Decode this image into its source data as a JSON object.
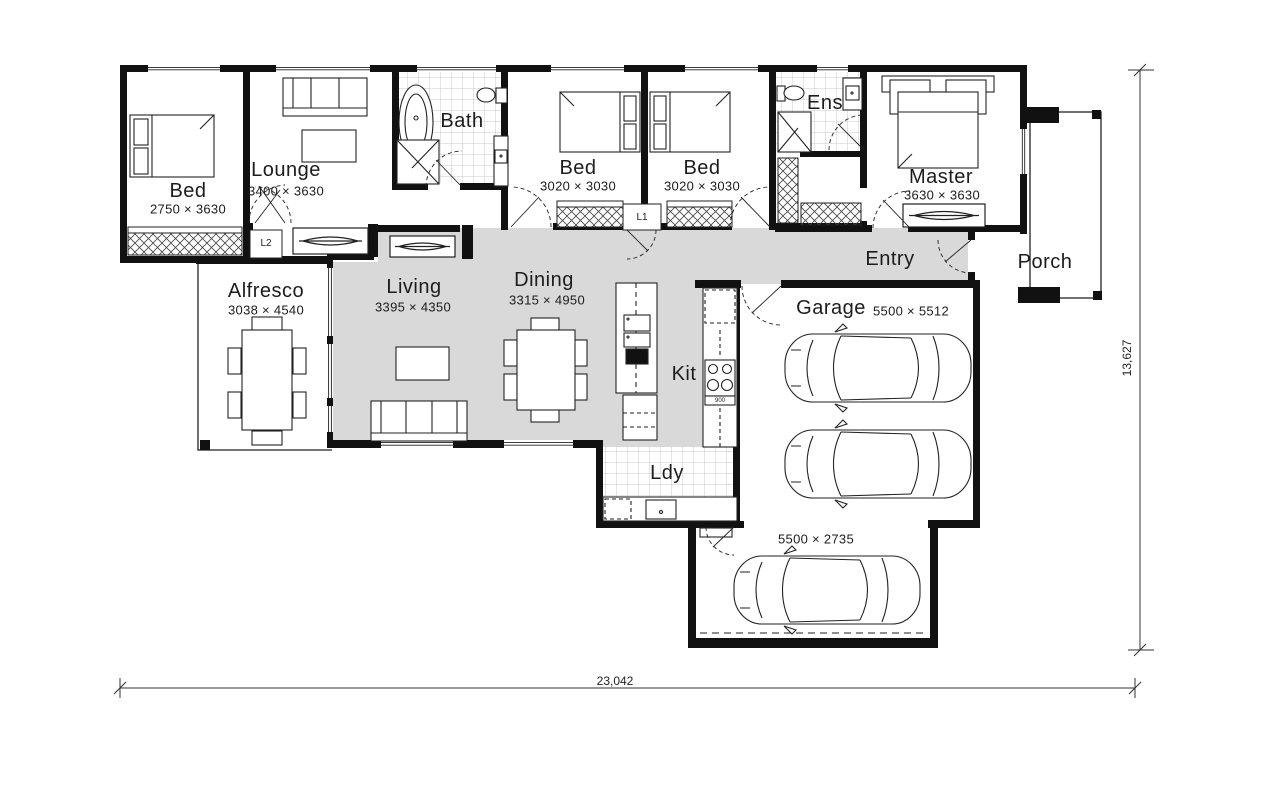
{
  "plan": {
    "rooms": {
      "bed1": {
        "name": "Bed",
        "dims": "2750 × 3630"
      },
      "lounge": {
        "name": "Lounge",
        "dims": "3400 × 3630"
      },
      "bath": {
        "name": "Bath"
      },
      "bed2": {
        "name": "Bed",
        "dims": "3020 × 3030"
      },
      "bed3": {
        "name": "Bed",
        "dims": "3020 × 3030"
      },
      "ens": {
        "name": "Ens"
      },
      "master": {
        "name": "Master",
        "dims": "3630 × 3630"
      },
      "entry": {
        "name": "Entry"
      },
      "porch": {
        "name": "Porch"
      },
      "alfresco": {
        "name": "Alfresco",
        "dims": "3038 × 4540"
      },
      "living": {
        "name": "Living",
        "dims": "3395 × 4350"
      },
      "dining": {
        "name": "Dining",
        "dims": "3315 × 4950"
      },
      "kit": {
        "name": "Kit"
      },
      "garage": {
        "name": "Garage",
        "dims": "5500 × 5512"
      },
      "ldy": {
        "name": "Ldy"
      },
      "carport": {
        "dims": "5500 × 2735"
      }
    },
    "cupboards": {
      "l1": "L1",
      "l2": "L2"
    },
    "appliances": {
      "cooktop_size": "900"
    },
    "overall_dimensions": {
      "width": "23,042",
      "depth": "13,627"
    },
    "colors": {
      "wall": "#111111",
      "floor_gray": "#d9d9d9",
      "tile_line": "#c9c9c9"
    }
  }
}
